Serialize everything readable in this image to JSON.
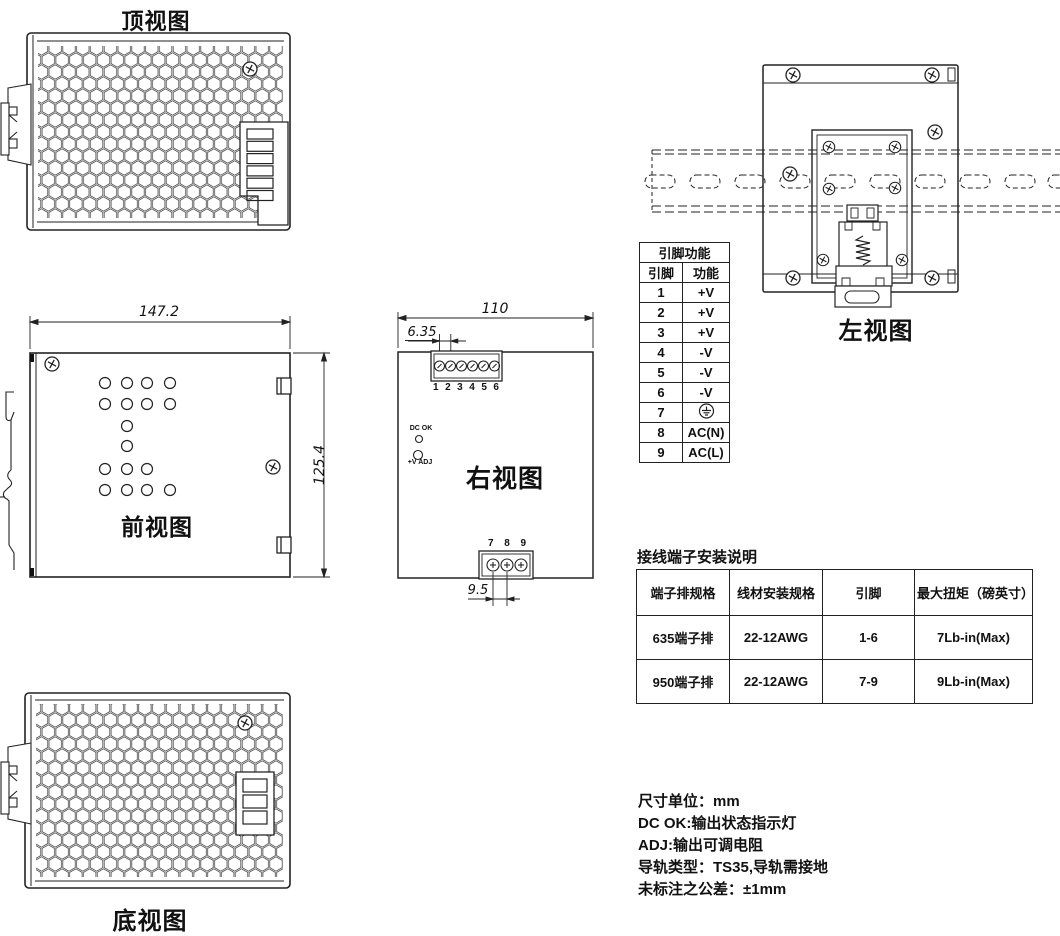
{
  "views": {
    "top": {
      "label": "顶视图"
    },
    "front": {
      "label": "前视图",
      "dim_width": "147.2",
      "dim_height": "125.4"
    },
    "bottom": {
      "label": "底视图"
    },
    "right": {
      "label": "右视图",
      "dim_width": "110",
      "dim_pitch_top": "6.35",
      "dim_pitch_bottom": "9.5",
      "top_terminals": [
        "1",
        "2",
        "3",
        "4",
        "5",
        "6"
      ],
      "bottom_terminals": [
        "7",
        "8",
        "9"
      ],
      "indicator_dc_ok": "DC OK",
      "indicator_adj": "+V ADJ"
    },
    "left": {
      "label": "左视图"
    }
  },
  "pin_table": {
    "title": "引脚功能",
    "headers": [
      "引脚",
      "功能"
    ],
    "rows": [
      [
        "1",
        "+V"
      ],
      [
        "2",
        "+V"
      ],
      [
        "3",
        "+V"
      ],
      [
        "4",
        "-V"
      ],
      [
        "5",
        "-V"
      ],
      [
        "6",
        "-V"
      ],
      [
        "7",
        "⏚"
      ],
      [
        "8",
        "AC(N)"
      ],
      [
        "9",
        "AC(L)"
      ]
    ],
    "ground_icon": "earth-ground-icon"
  },
  "terminal_table": {
    "title": "接线端子安装说明",
    "headers": [
      "端子排规格",
      "线材安装规格",
      "引脚",
      "最大扭矩（磅英寸）"
    ],
    "rows": [
      [
        "635端子排",
        "22-12AWG",
        "1-6",
        "7Lb-in(Max)"
      ],
      [
        "950端子排",
        "22-12AWG",
        "7-9",
        "9Lb-in(Max)"
      ]
    ]
  },
  "notes": [
    "尺寸单位：mm",
    "DC OK:输出状态指示灯",
    "ADJ:输出可调电阻",
    "导轨类型：TS35,导轨需接地",
    "未标注之公差：±1mm"
  ],
  "colors": {
    "line": "#222222",
    "background": "#ffffff",
    "text": "#111111"
  }
}
